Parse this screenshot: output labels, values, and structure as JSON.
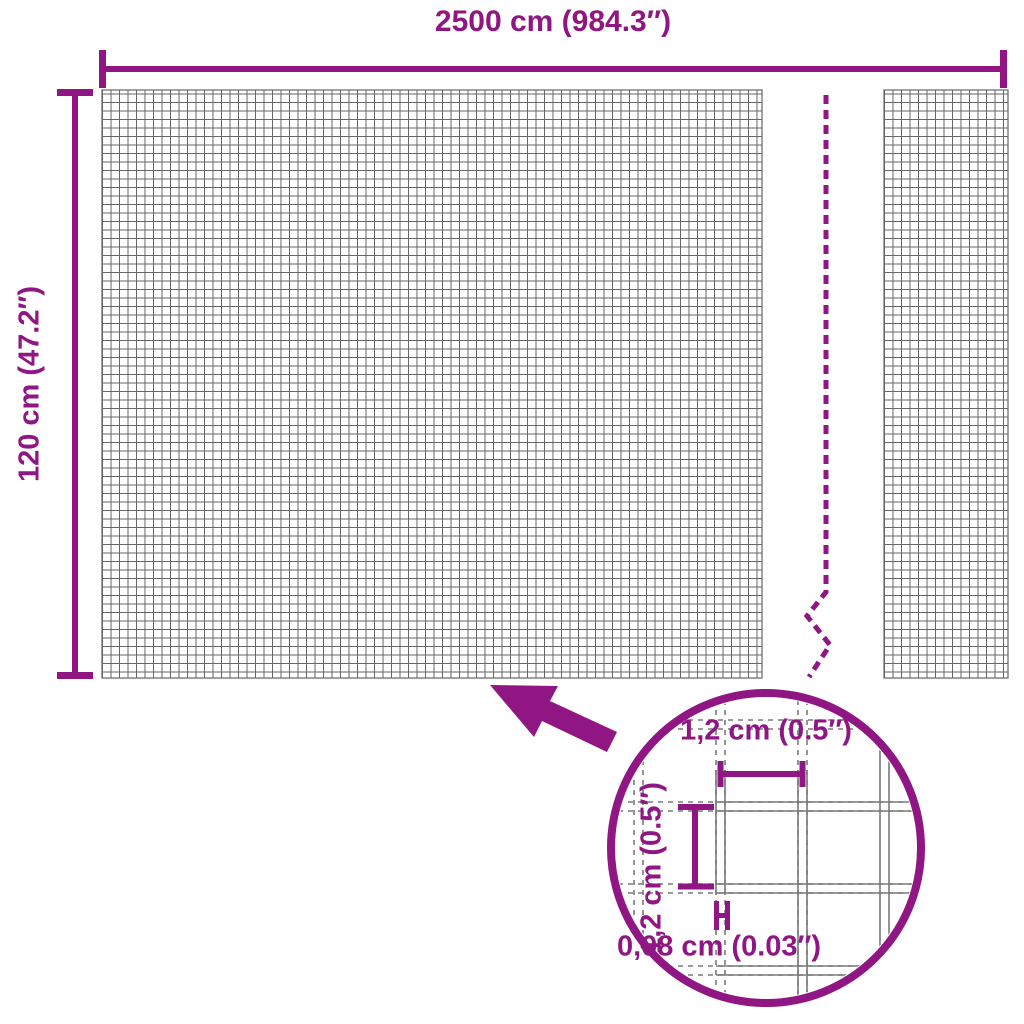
{
  "diagram": {
    "accent_color": "#8F1683",
    "grid_color": "#666666",
    "wire_color": "#7A7A7A",
    "background_color": "#FFFFFF",
    "total_width_label": "2500 cm (984.3″)",
    "height_label": "120 cm (47.2″)",
    "detail": {
      "mesh_width_label": "1,2 cm (0.5″)",
      "mesh_height_label": "1,2 cm (0.5″)",
      "wire_thickness_label": "0,08 cm (0.03″)"
    }
  }
}
